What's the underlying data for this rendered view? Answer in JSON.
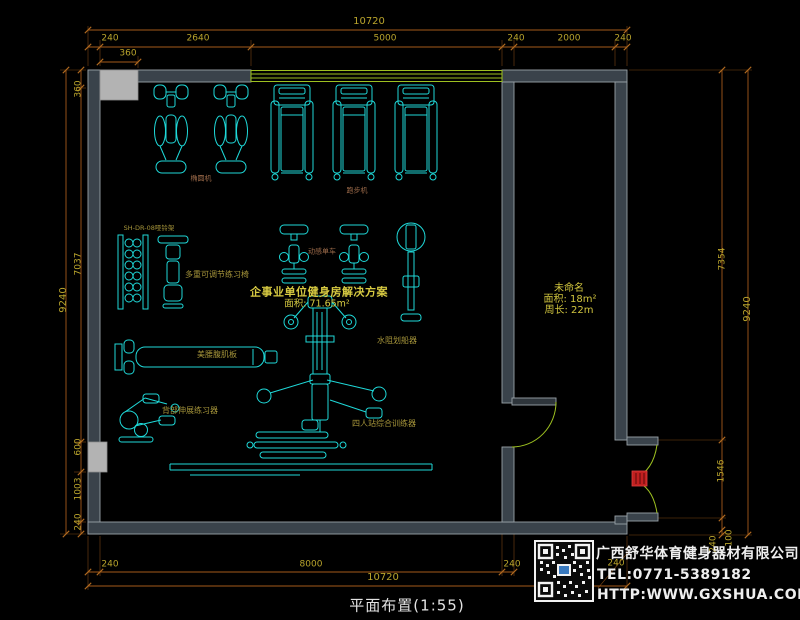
{
  "drawing": {
    "title": "平面布置(1:55)",
    "main_room": {
      "line1": "企事业单位健身房解决方案",
      "line2": "面积: 71.65m²"
    },
    "side_room": {
      "name": "未命名",
      "area": "面积: 18m²",
      "perimeter": "周长: 22m"
    },
    "equipment_labels": {
      "elliptical": "椭圆机",
      "treadmill": "跑步机",
      "dumbbell_rack": "SH-DR-08哑铃架",
      "adjustable_bench": "多重可调节练习椅",
      "spin_bike": "动感单车",
      "rowing_machine": "水阻划船器",
      "ab_board": "美腰腹肌板",
      "back_stretch": "背部伸展练习器",
      "multi_station": "四人站综合训练器"
    }
  },
  "dimensions": {
    "top": {
      "total": "10720",
      "seg1": "240",
      "seg2": "2640",
      "seg3": "5000",
      "seg4": "240",
      "seg5": "2000",
      "seg6": "240",
      "sub": "360"
    },
    "left": {
      "total": "9240",
      "seg1": "360",
      "seg2": "7037",
      "seg3": "600",
      "seg4": "1003",
      "seg5": "240"
    },
    "right": {
      "seg1": "7354",
      "total": "9240",
      "seg2": "1546",
      "seg3": "240",
      "seg4": "100"
    },
    "bottom": {
      "seg1": "240",
      "seg2": "8000",
      "seg3": "240",
      "total": "10720",
      "corner": "240"
    }
  },
  "company": {
    "name": "广西舒华体育健身器材有限公司",
    "tel": "TEL:0771-5389182",
    "web": "HTTP:WWW.GXSHUA.COM"
  },
  "colors": {
    "equipment": "#1fd9d9",
    "walls": "#3a434b",
    "window": "#9dc020",
    "dimension_line": "#a45a1a",
    "dimension_text": "#b9a42c",
    "door_marker": "#c02020",
    "room_text": "#d8cb42"
  }
}
